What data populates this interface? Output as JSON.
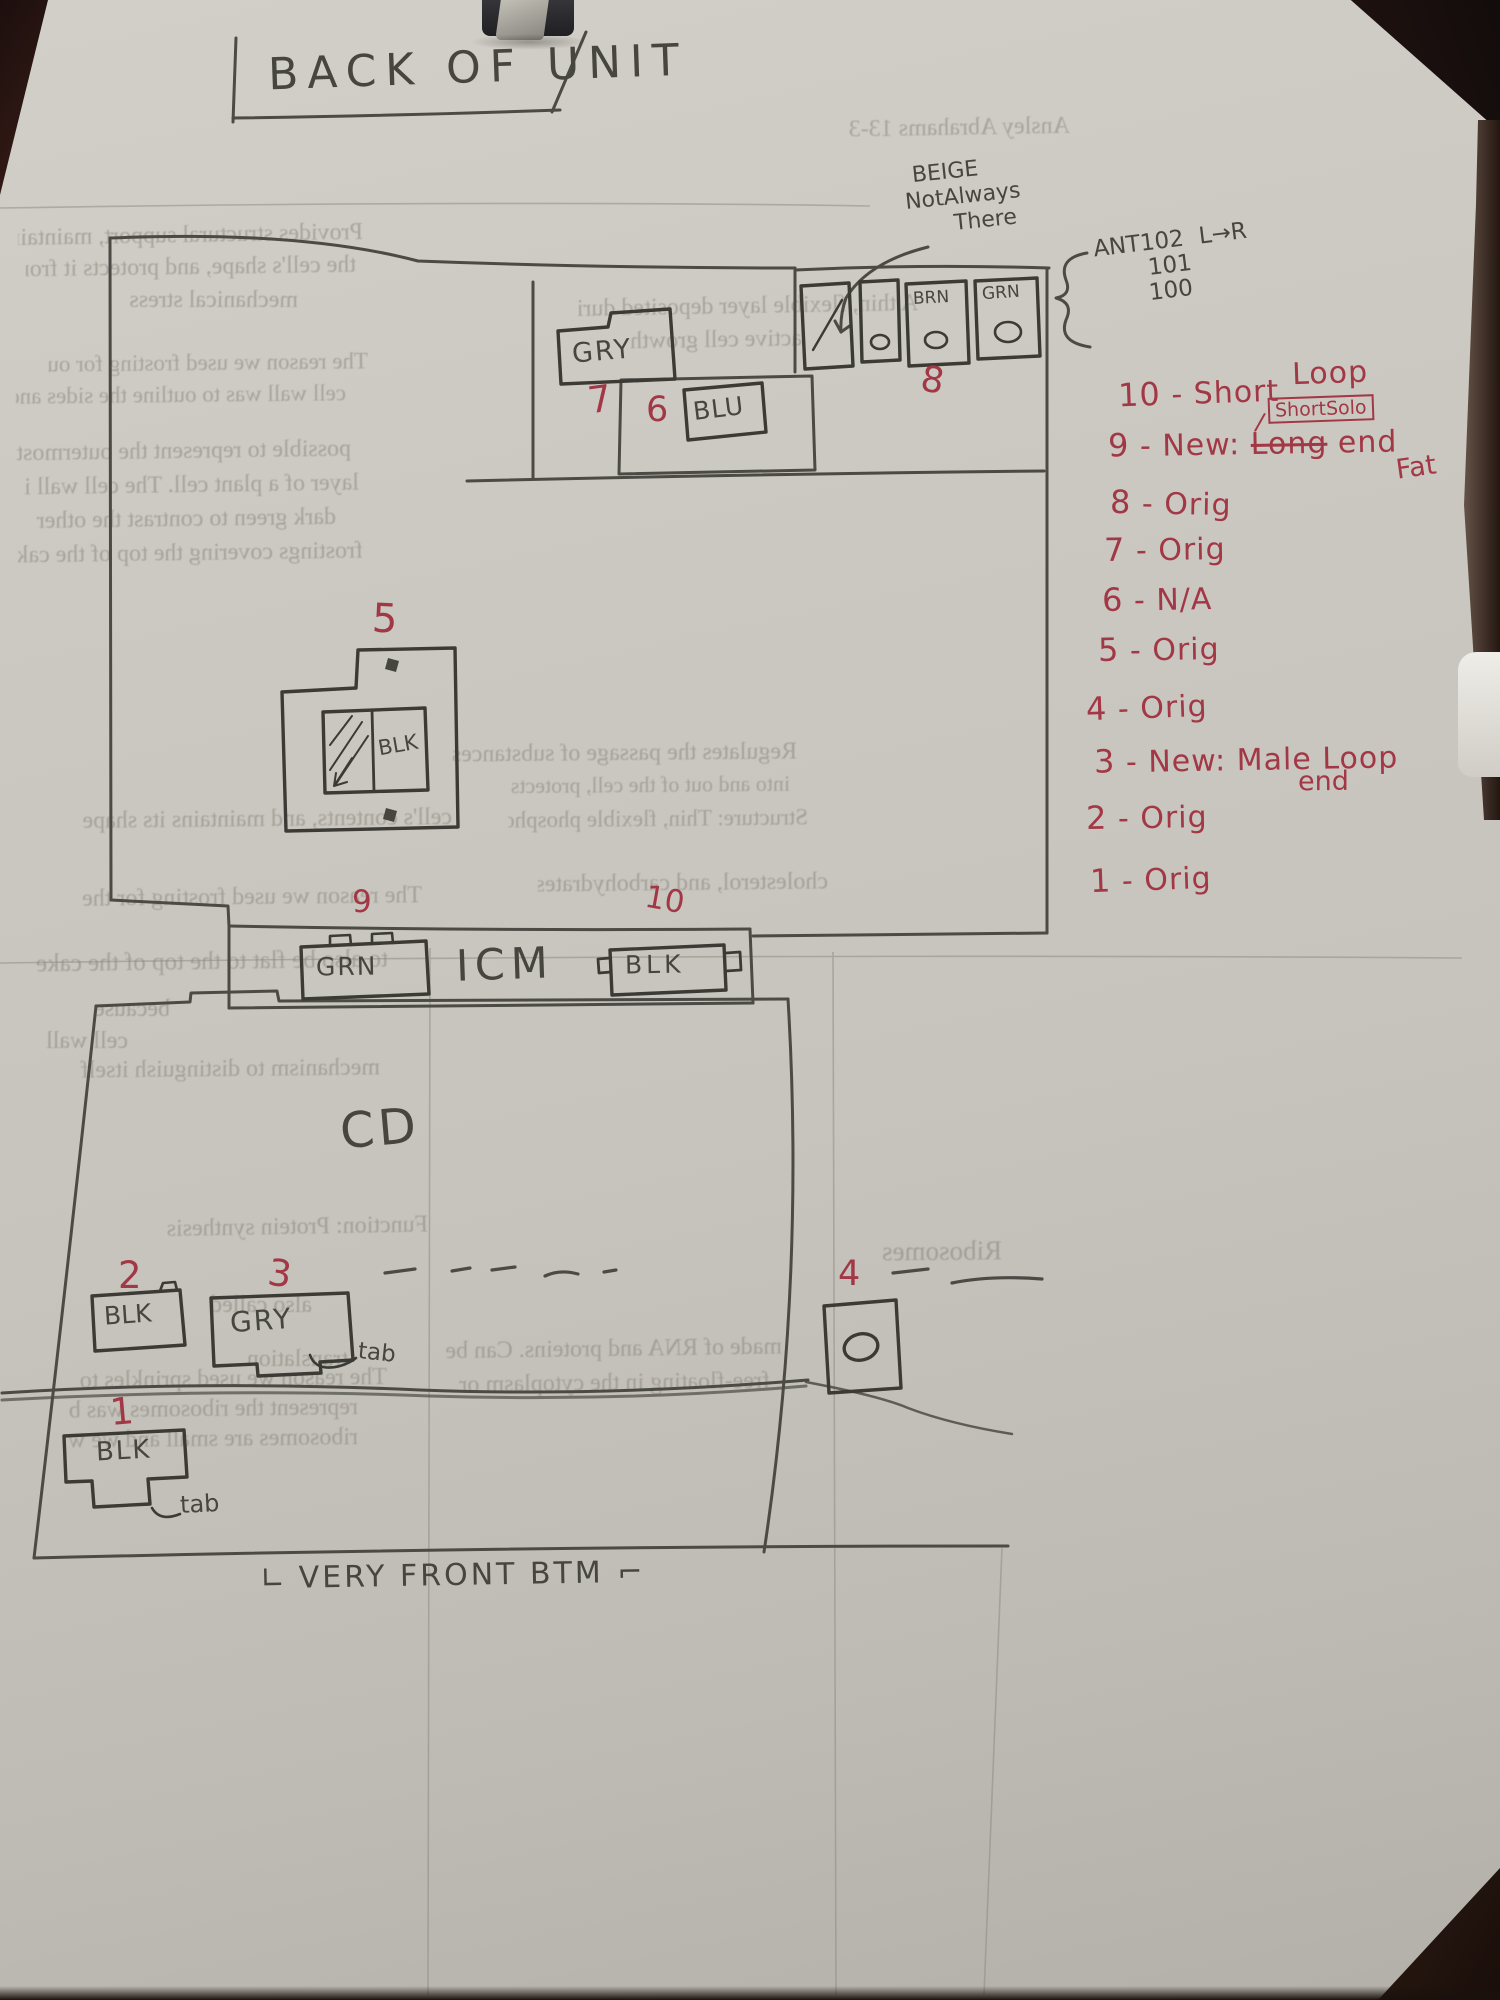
{
  "palette": {
    "paper": "#c9c6bf",
    "pencil": "#46453f",
    "ink": "#3b3a35",
    "red": "#a23846",
    "bleed_text": "#87847b",
    "background": "#17100d"
  },
  "title": "BACK OF UNIT",
  "notes": {
    "beige": {
      "line1": "BEIGE",
      "line2": "NotAlways",
      "line3": "There"
    },
    "ant": {
      "line1": "ANT102",
      "dir": "L→R",
      "line2": "101",
      "line3": "100"
    }
  },
  "legend": {
    "items": [
      {
        "num": "10",
        "text": "- Short",
        "raised": "Loop",
        "boxed": "ShortSolo"
      },
      {
        "num": "9",
        "text": "- New:",
        "struck": "Long",
        "after": "end",
        "below": "Fat"
      },
      {
        "num": "8",
        "text": "- Orig"
      },
      {
        "num": "7",
        "text": "- Orig"
      },
      {
        "num": "6",
        "text": "- N/A"
      },
      {
        "num": "5",
        "text": "- Orig"
      },
      {
        "num": "4",
        "text": "- Orig"
      },
      {
        "num": "3",
        "text": "- New: Male Loop",
        "below": "end"
      },
      {
        "num": "2",
        "text": "- Orig"
      },
      {
        "num": "1",
        "text": "- Orig"
      }
    ]
  },
  "components": {
    "c7": {
      "num": "7",
      "label": "GRY"
    },
    "c8": {
      "num": "8",
      "label_brn": "BRN",
      "label_grn": "GRN"
    },
    "c6": {
      "num": "6",
      "label": "BLU"
    },
    "c5": {
      "num": "5",
      "label": "BLK"
    },
    "c9": {
      "num": "9",
      "label": "GRN"
    },
    "icm": {
      "label": "ICM"
    },
    "c10": {
      "num": "10",
      "label": "BLK"
    },
    "cd": {
      "label": "CD"
    },
    "c2": {
      "num": "2",
      "label": "BLK"
    },
    "c3": {
      "num": "3",
      "label": "GRY",
      "tab": "tab"
    },
    "c4": {
      "num": "4"
    },
    "c1": {
      "num": "1",
      "label": "BLK",
      "tab": "tab"
    }
  },
  "footer": {
    "prefix": "∟",
    "label": "VERY FRONT BTM",
    "suffix": "⌐"
  },
  "bleed": {
    "lines": [
      "Ansley Abrahams    13-3",
      "Provides structural support, maintains",
      "the cell's shape, and protects it from",
      "mechanical stress",
      "The reason we used frosting for our",
      "cell wall was to outline the sides and",
      "possible to represent the outermost",
      "layer of a plant cell. The cell wall is",
      "dark green to contrast the other",
      "frostings covering the top of the cake",
      "A thin, flexible layer deposited during",
      "active cell growth",
      "Regulates the passage of substances",
      "cell's contents, and maintains its shape",
      "Structure: Thin, flexible phospholipid",
      "cholesterol, and carbohydrates.",
      "The reason we used frosting for the",
      "to also be flat to the top of the cake",
      "because",
      "cell wall",
      "mechanism to distinguish itself",
      "Function: Protein synthesis",
      "Ribosomes",
      "also called",
      "translation",
      "The reason we used sprinkles to",
      "represent the ribosomes was b",
      "ribosomes are small and we w",
      "made of RNA and proteins. Can be",
      "free-floating in the cytoplasm or",
      "into and out of the cell, protects the"
    ]
  }
}
